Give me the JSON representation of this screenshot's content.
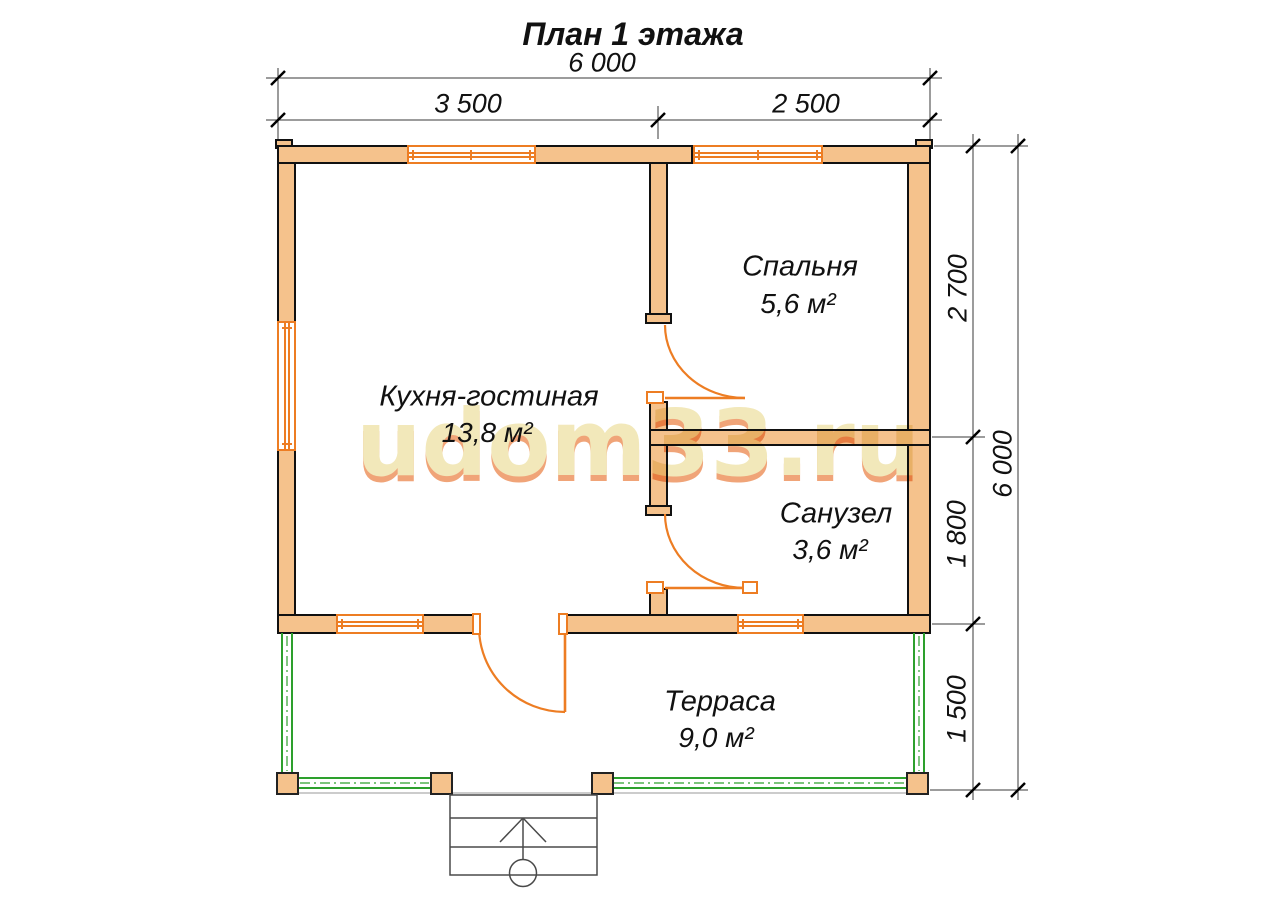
{
  "title": "План 1 этажа",
  "watermark": {
    "text": "udom33.ru",
    "color": "#f2e8ba"
  },
  "dimensions": {
    "top": {
      "total": "6 000",
      "segments": [
        "3 500",
        "2 500"
      ]
    },
    "right": {
      "total": "6 000",
      "segments": [
        "2 700",
        "1 800",
        "1 500"
      ]
    }
  },
  "rooms": [
    {
      "name": "Кухня-гостиная",
      "area": "13,8 м²"
    },
    {
      "name": "Спальня",
      "area": "5,6 м²"
    },
    {
      "name": "Санузел",
      "area": "3,6 м²"
    },
    {
      "name": "Терраса",
      "area": "9,0 м²"
    }
  ],
  "colors": {
    "wall": "#f5c28c",
    "joinery": "#ed7d23",
    "terrace_railing": "#2da02d",
    "outline": "#111111",
    "dimension_line": "#3a3a3a"
  },
  "symbols": {
    "entrance_direction": "arrow-up",
    "entrance_point": "circle"
  }
}
